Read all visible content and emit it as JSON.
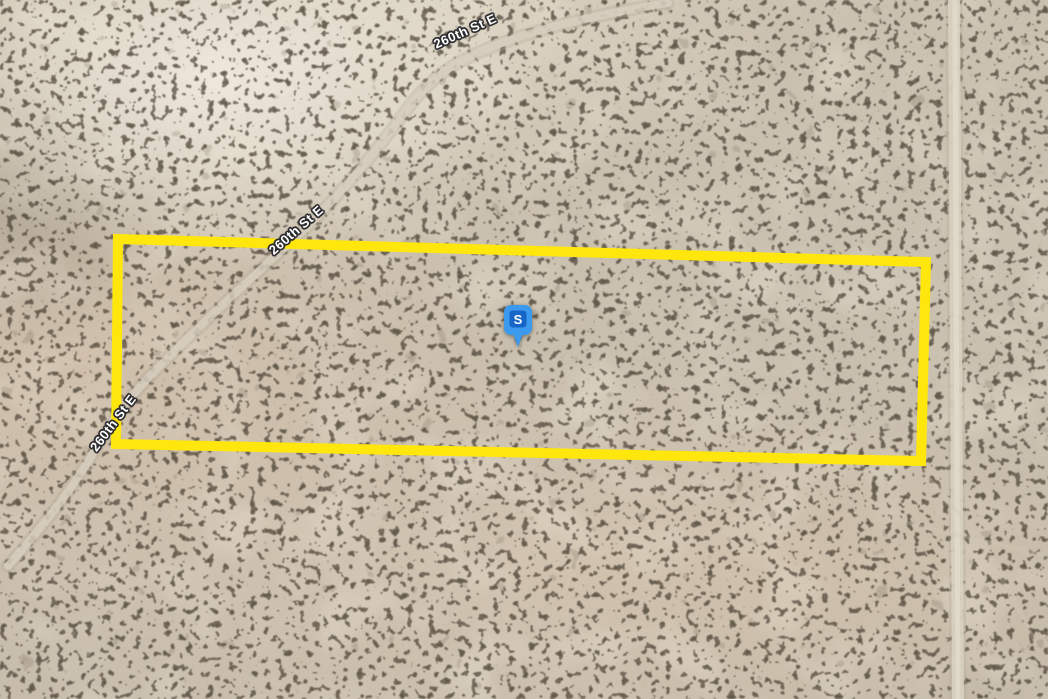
{
  "map": {
    "road_label": "260th St E",
    "marker": {
      "letter": "S",
      "fill": "#3B9AEE",
      "inner_fill": "#1765C8",
      "letter_color": "#FFFFFF"
    },
    "parcel": {
      "points": "118,239 926,262 921,461 116,444",
      "outline_color": "#FFE70D"
    },
    "terrain": {
      "base_color": "#C9BEAC",
      "bush_color": "#4C4436",
      "sand_highlight_color": "#EDE6D6",
      "road_color": "#D8D0C0"
    }
  }
}
